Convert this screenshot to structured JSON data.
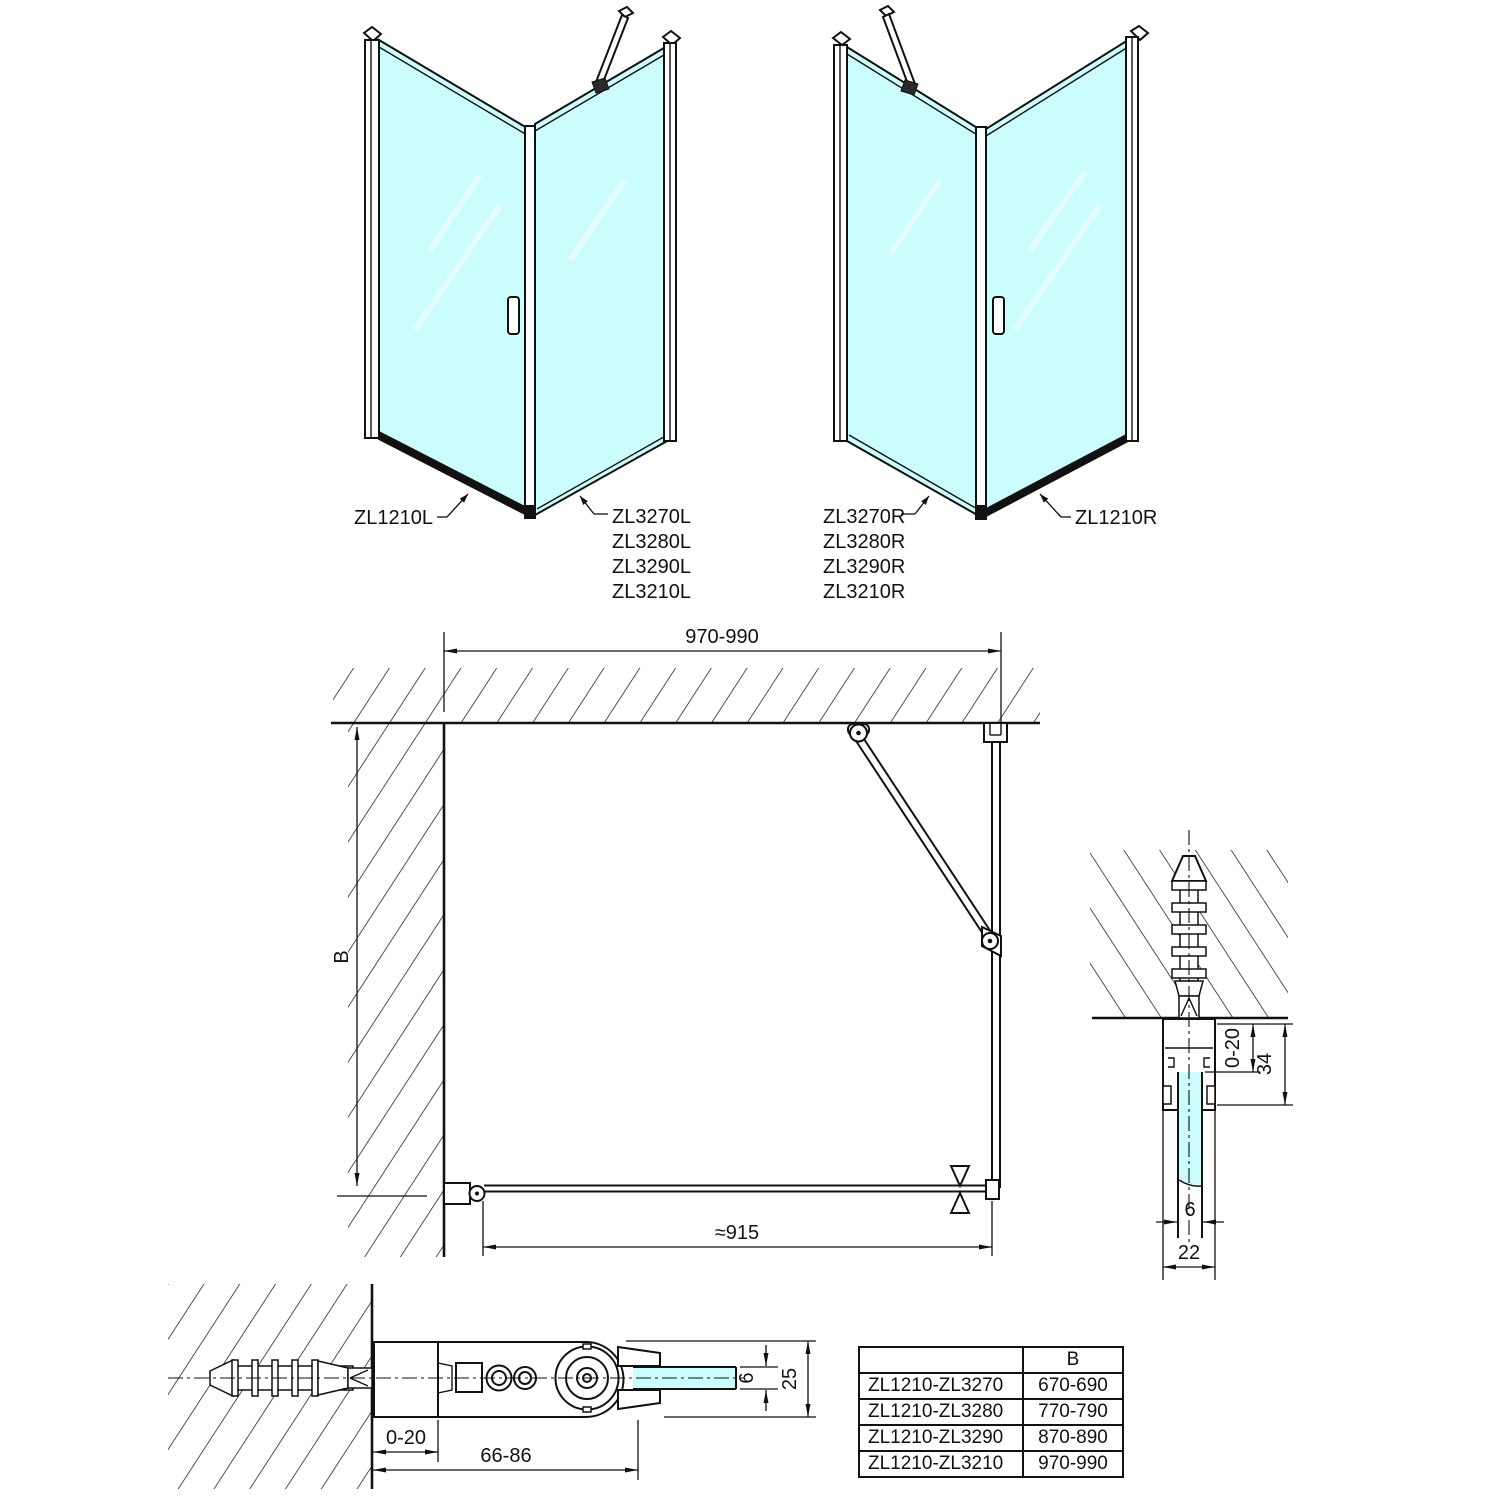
{
  "colors": {
    "glass": "#ccfdfd",
    "line": "#111111"
  },
  "units": {
    "left": {
      "door_label": "ZL1210L",
      "panel_labels": [
        "ZL3270L",
        "ZL3280L",
        "ZL3290L",
        "ZL3210L"
      ]
    },
    "right": {
      "door_label": "ZL1210R",
      "panel_labels": [
        "ZL3270R",
        "ZL3280R",
        "ZL3290R",
        "ZL3210R"
      ]
    }
  },
  "plan": {
    "width_dim": "970-990",
    "depth_dim": "B",
    "door_dim": "≈915"
  },
  "wall_profile_detail": {
    "inset_dim": "0-20",
    "depth_dim": "34",
    "glass_dim": "6",
    "width_dim": "22"
  },
  "hinge_detail": {
    "inset_dim": "0-20",
    "range_dim": "66-86",
    "glass_dim": "6",
    "height_dim": "25"
  },
  "size_table": {
    "col0_header": "",
    "col_header": "B",
    "rows": [
      [
        "ZL1210-ZL3270",
        "670-690"
      ],
      [
        "ZL1210-ZL3280",
        "770-790"
      ],
      [
        "ZL1210-ZL3290",
        "870-890"
      ],
      [
        "ZL1210-ZL3210",
        "970-990"
      ]
    ]
  }
}
